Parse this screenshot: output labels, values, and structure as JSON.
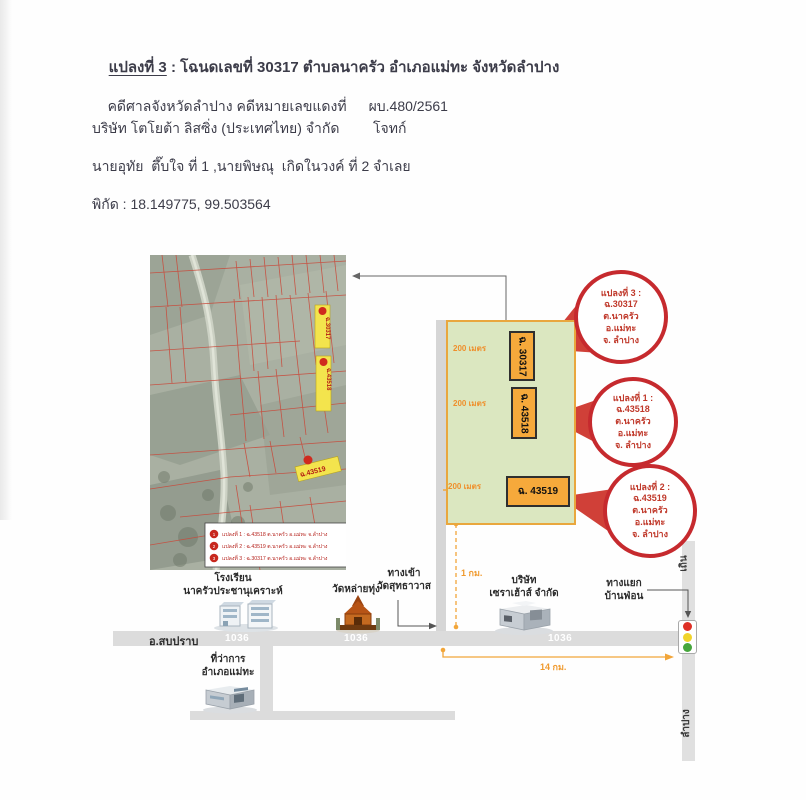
{
  "header": {
    "title_plot": "แปลงที่ 3",
    "title_rest": " : โฉนดเลขที่ 30317 ตำบลนาครัว อำเภอแม่ทะ จังหวัดลำปาง",
    "case_label": "คดีศาลจังหวัดลำปาง คดีหมายเลขแดงที่",
    "case_number": "ผบ.480/2561",
    "plaintiff": "บริษัท โตโยต้า ลิสซิ่ง (ประเทศไทย) จำกัด",
    "plaintiff_role": "โจทก์",
    "defendant": "นายอุทัย  ตึ๊บใจ ที่ 1 ,นายพิษณุ  เกิดในวงค์ ที่ 2",
    "defendant_role": "จำเลย",
    "coordinates": "พิกัด : 18.149775, 99.503564"
  },
  "aerial_map": {
    "plot_labels": [
      "ฉ.30317",
      "ฉ.43518",
      "ฉ.43519"
    ],
    "legend": {
      "rows": [
        {
          "num": "1",
          "text": "แปลงที่ 1 : ฉ.43518 ต.นาครัว อ.แม่ทะ จ.ลำปาง"
        },
        {
          "num": "2",
          "text": "แปลงที่ 2 : ฉ.43519 ต.นาครัว อ.แม่ทะ จ.ลำปาง"
        },
        {
          "num": "3",
          "text": "แปลงที่ 3 : ฉ.30317 ต.นาครัว อ.แม่ทะ จ.ลำปาง"
        }
      ]
    }
  },
  "diagram": {
    "plot_boxes": [
      {
        "label": "ฉ. 30317"
      },
      {
        "label": "ฉ. 43518"
      },
      {
        "label": "ฉ. 43519"
      }
    ],
    "measure_label": "200 เมตร",
    "distance_1km": "1 กม.",
    "distance_14km": "14 กม.",
    "callouts": [
      {
        "lines": [
          "แปลงที่ 3 :",
          "ฉ.30317",
          "ต.นาครัว",
          "อ.แม่ทะ",
          "จ. ลำปาง"
        ]
      },
      {
        "lines": [
          "แปลงที่ 1 :",
          "ฉ.43518",
          "ต.นาครัว",
          "อ.แม่ทะ",
          "จ. ลำปาง"
        ]
      },
      {
        "lines": [
          "แปลงที่ 2 :",
          "ฉ.43519",
          "ต.นาครัว",
          "อ.แม่ทะ",
          "จ. ลำปาง"
        ]
      }
    ]
  },
  "places": {
    "school": {
      "line1": "โรงเรียน",
      "line2": "นาครัวประชานุเคราะห์"
    },
    "temple": {
      "line1": "วัดหล่ายทุ่ง"
    },
    "wat_entrance": {
      "line1": "ทางเข้า",
      "line2": "วัดสุทธาวาส"
    },
    "company": {
      "line1": "บริษัท",
      "line2": "เซราเฮ้าส์ จำกัด"
    },
    "junction": {
      "line1": "ทางแยก",
      "line2": "บ้านฟ่อน"
    },
    "district_office": {
      "line1": "ที่ว่าการ",
      "line2": "อำเภอแม่ทะ"
    },
    "road_left_label": "อ.สบปราบ",
    "road_number": "1036",
    "road_up_label": "เถิน",
    "road_down_label": "ลำปาง"
  },
  "colors": {
    "callout_red": "#c62a2e",
    "plot_orange": "#f6a93b",
    "area_green": "#dbe7c0",
    "measure_orange": "#f09a2e",
    "map_label_yellow": "#f3e44d",
    "road_gray": "#dcdcdc",
    "traffic_red": "#de3026",
    "traffic_yellow": "#f0d32a",
    "traffic_green": "#46a63c"
  }
}
